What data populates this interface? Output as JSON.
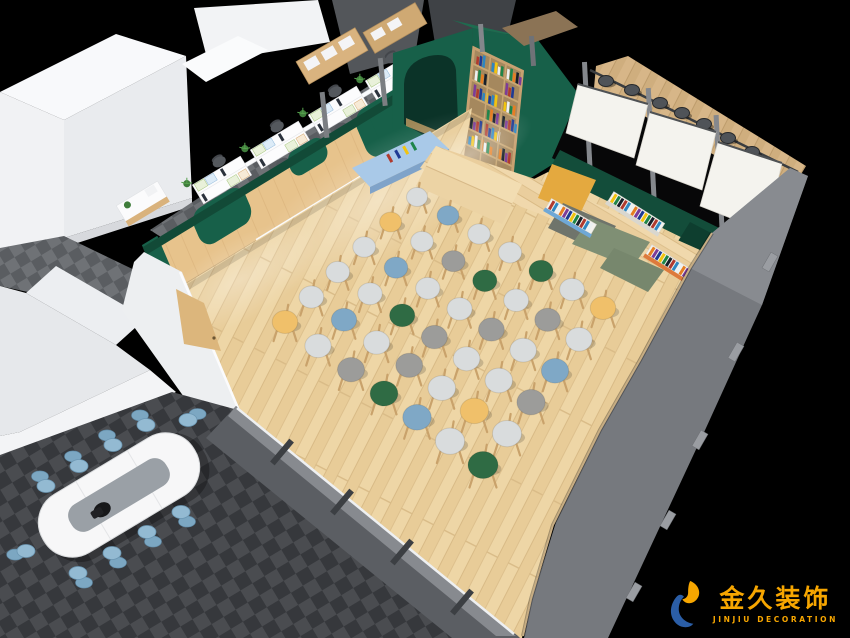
{
  "logo": {
    "brand_cn": "金久装饰",
    "brand_en": "JINJIU DECORATION"
  },
  "colors": {
    "background": "#000000",
    "logo_orange": "#f7a600",
    "logo_blue": "#2b5ea7",
    "green_wall": "#176049",
    "green_dark": "#124a37",
    "green_top": "#1e6b4f",
    "wood_floor": "#eed6a6",
    "wood_wall": "#e7c38c",
    "door_wood": "#dcb67c",
    "shelf_blue": "#a9c9e8",
    "screen_white": "#f4f3ee",
    "frame_gray": "#76797e",
    "carpet_gray_light": "#6f7276",
    "carpet_gray_dark": "#3e4044",
    "table_white": "#f7f7f8",
    "table_inset": "#9aa0a6",
    "chair_blue": "#93bad2",
    "mat_yellow": "#e4a93f",
    "mat_sage": "#7f8f74",
    "bench_green": "#134d3a",
    "stool": {
      "L": "#d9dcdd",
      "W": "#9c9c9a",
      "B": "#7fa8c6",
      "G": "#2f6b44",
      "Y": "#f0c06a",
      "legs": "#c9a26b"
    }
  },
  "scene": {
    "stool_grid": {
      "rows": 6,
      "cols": 7,
      "corner_n": [
        417,
        197
      ],
      "corner_e": [
        603,
        308
      ],
      "corner_w": [
        285,
        322
      ],
      "corner_s": [
        483,
        465
      ],
      "colors": [
        [
          "L",
          "B",
          "L",
          "L",
          "G",
          "L",
          "Y"
        ],
        [
          "Y",
          "L",
          "W",
          "G",
          "L",
          "W",
          "L"
        ],
        [
          "L",
          "B",
          "L",
          "L",
          "W",
          "L",
          "B"
        ],
        [
          "L",
          "L",
          "G",
          "W",
          "L",
          "L",
          "W"
        ],
        [
          "L",
          "B",
          "L",
          "W",
          "L",
          "Y",
          "L"
        ],
        [
          "Y",
          "L",
          "W",
          "G",
          "B",
          "L",
          "G"
        ]
      ]
    },
    "conference_chairs": [
      [
        46,
        486,
        -5,
        -8
      ],
      [
        79,
        466,
        -5,
        -8
      ],
      [
        113,
        445,
        -5,
        -8
      ],
      [
        146,
        425,
        -5,
        -8
      ],
      [
        78,
        573,
        5,
        8
      ],
      [
        112,
        553,
        5,
        8
      ],
      [
        147,
        532,
        5,
        8
      ],
      [
        181,
        512,
        5,
        8
      ],
      [
        26,
        551,
        -9,
        3
      ],
      [
        188,
        420,
        8,
        -5
      ]
    ],
    "bar_stools": [
      [
        606,
        81
      ],
      [
        632,
        90
      ],
      [
        660,
        103
      ],
      [
        682,
        113
      ],
      [
        704,
        124
      ],
      [
        728,
        138
      ],
      [
        752,
        152
      ]
    ],
    "office_bays": [
      [
        222,
        180
      ],
      [
        280,
        145
      ],
      [
        338,
        110
      ],
      [
        395,
        76
      ]
    ],
    "book_palette": [
      "#b03a2e",
      "#1f3a93",
      "#2e86c1",
      "#f1c40f",
      "#ecf0f1",
      "#1e8449",
      "#e67e22",
      "#17202a",
      "#7d3c98"
    ],
    "display_racks": [
      [
        546,
        208,
        30,
        52,
        "#6fa8d6"
      ],
      [
        608,
        201,
        32,
        60,
        "#d9d7cf"
      ],
      [
        646,
        254,
        32,
        62,
        "#dd7a3c"
      ]
    ],
    "bookshelf": {
      "rows": 6,
      "cols": 3
    }
  }
}
